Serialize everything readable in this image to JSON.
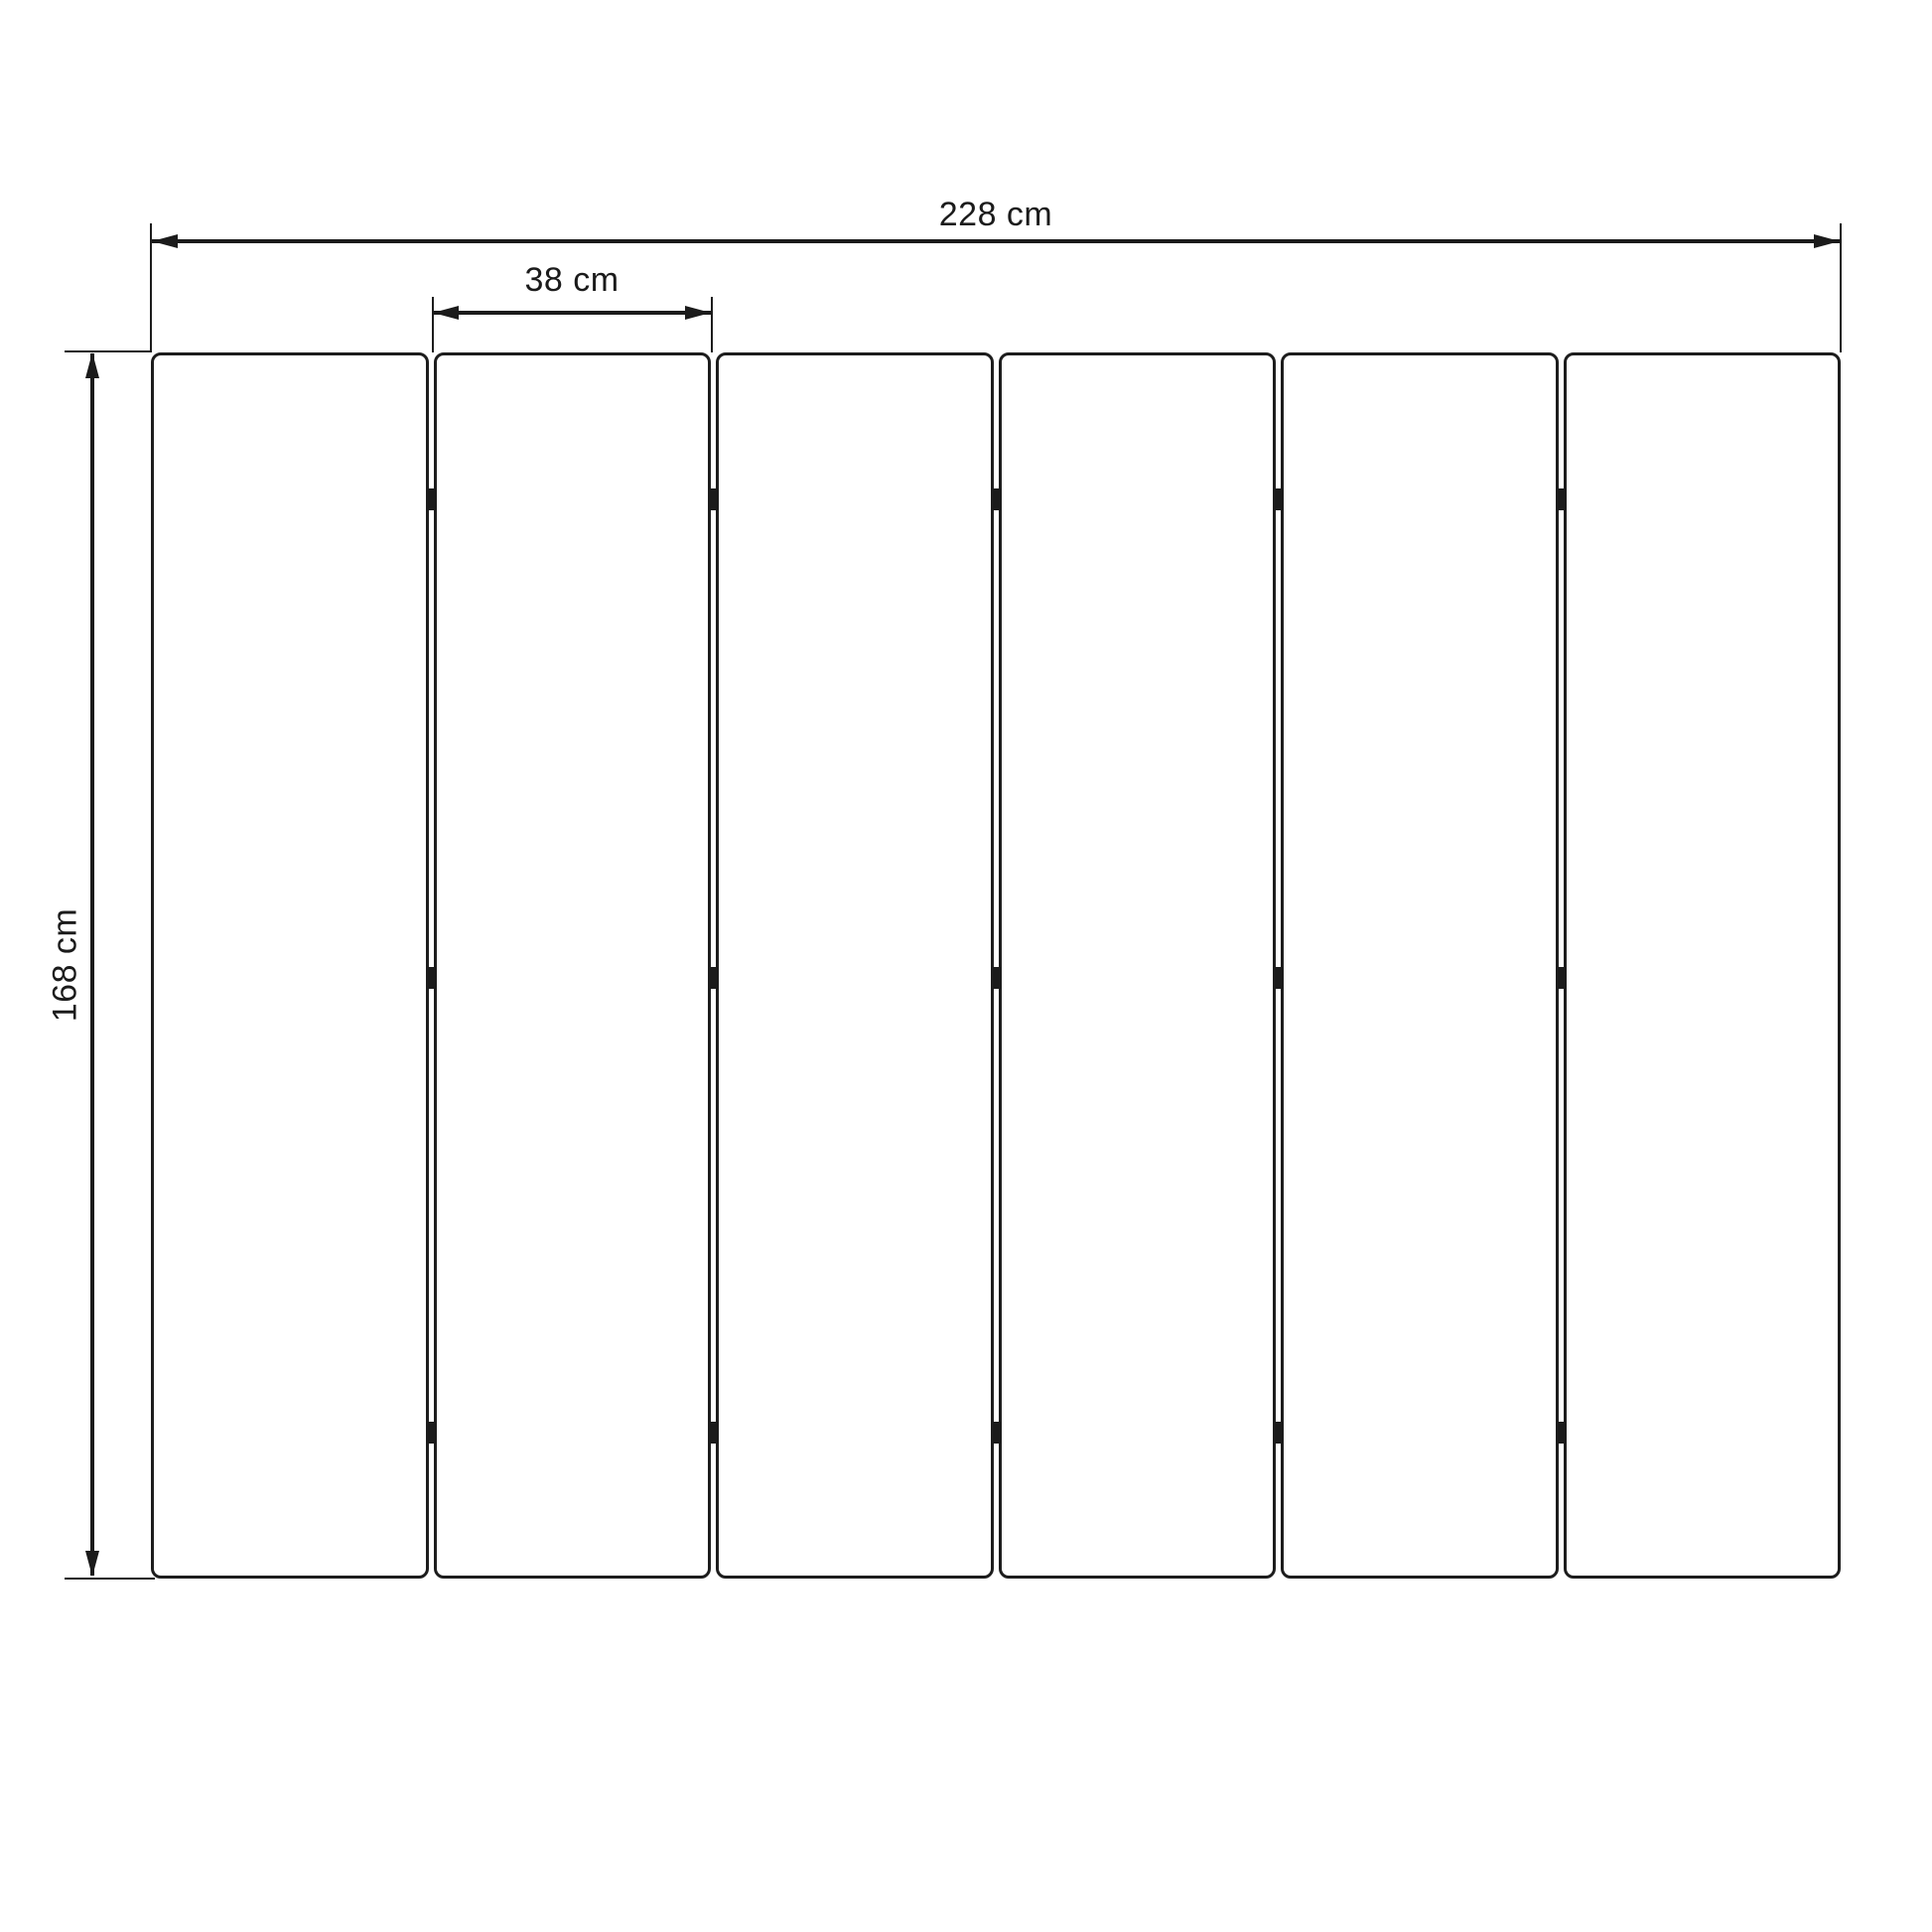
{
  "colors": {
    "stroke": "#1b1b1b",
    "background": "#ffffff"
  },
  "dimensions": {
    "total_width": {
      "label": "228 cm",
      "value": 228,
      "unit": "cm"
    },
    "panel_width": {
      "label": "38 cm",
      "value": 38,
      "unit": "cm"
    },
    "height": {
      "label": "168 cm",
      "value": 168,
      "unit": "cm"
    }
  },
  "panels": {
    "count": 6,
    "gap_count": 5,
    "connector_rows_per_gap": 3
  }
}
